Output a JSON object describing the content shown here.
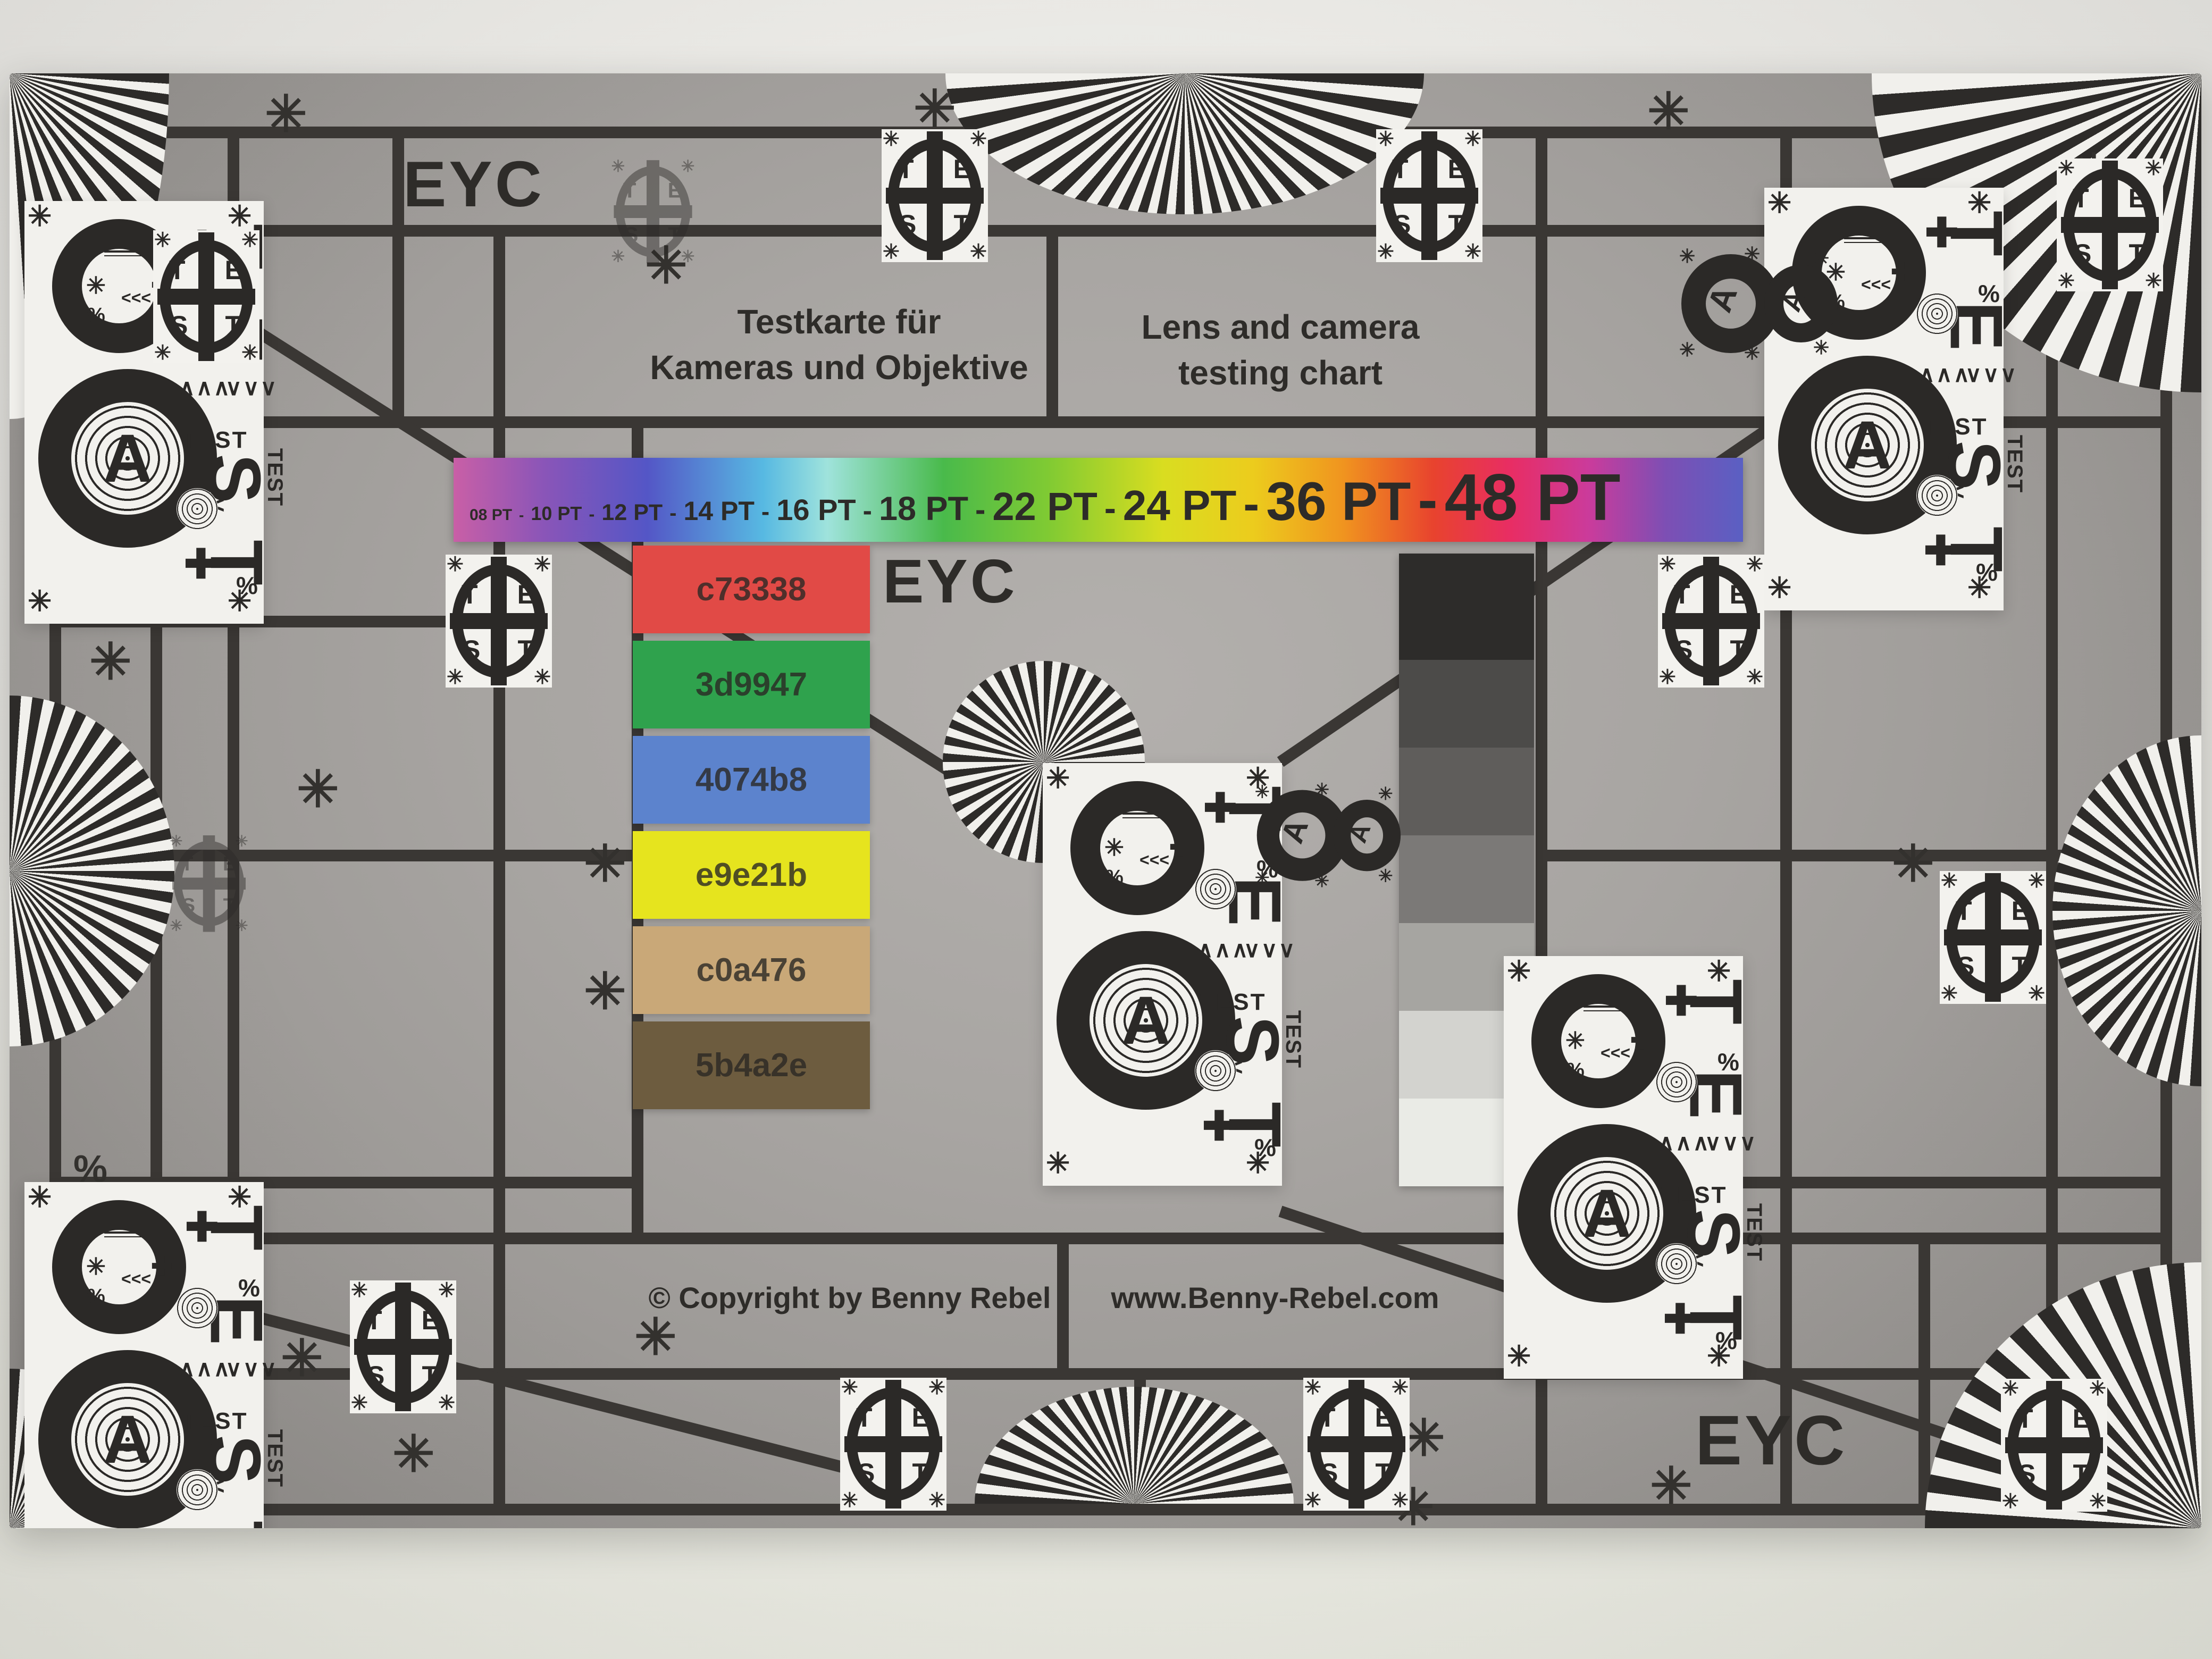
{
  "eyc": {
    "top_left": "EYC",
    "center": "EYC",
    "bottom_right": "EYC"
  },
  "titles": {
    "de1": "Testkarte für",
    "de2": "Kameras und Objektive",
    "en1": "Lens and camera",
    "en2": "testing chart"
  },
  "footer": {
    "copyright": "© Copyright by Benny Rebel",
    "website": "www.Benny-Rebel.com"
  },
  "pt": {
    "labels": [
      "08 PT",
      "10 PT",
      "12 PT",
      "14 PT",
      "16 PT",
      "18 PT",
      "22 PT",
      "24 PT",
      "36 PT",
      "48 PT"
    ],
    "sep": "-"
  },
  "swatches": [
    {
      "label": "c73338",
      "color": "#e14a46"
    },
    {
      "label": "3d9947",
      "color": "#2fa24d"
    },
    {
      "label": "4074b8",
      "color": "#5c83cd"
    },
    {
      "label": "e9e21b",
      "color": "#e6e41e"
    },
    {
      "label": "c0a476",
      "color": "#c9a878"
    },
    {
      "label": "5b4a2e",
      "color": "#6d5c3f"
    }
  ],
  "grayscale": [
    "#2d2c2a",
    "#4c4b49",
    "#5f5d5b",
    "#7b7977",
    "#a6a5a1",
    "#d3d3cf",
    "#eaebe6"
  ],
  "colors": {
    "grid_line": "#3a3734",
    "paper_white": "#f2f1ed",
    "ink": "#2b2927",
    "chart_gray": "#a8a5a2"
  },
  "logo": {
    "t1": "T",
    "e": "E",
    "s": "S",
    "t2": "T",
    "ast": "✳"
  },
  "p8": {
    "a": "A",
    "t": [
      "T",
      "E",
      "S",
      "T"
    ],
    "test": "TEST",
    "up": "∧∧∧",
    "down": "∨∨∨",
    "lt": "<<<",
    "plus": "✚",
    "pct": "%",
    "ast": "✳"
  },
  "badge": {
    "a": "A",
    "ast": "✳"
  },
  "marks": {
    "ast": "✳",
    "pct": "%"
  }
}
